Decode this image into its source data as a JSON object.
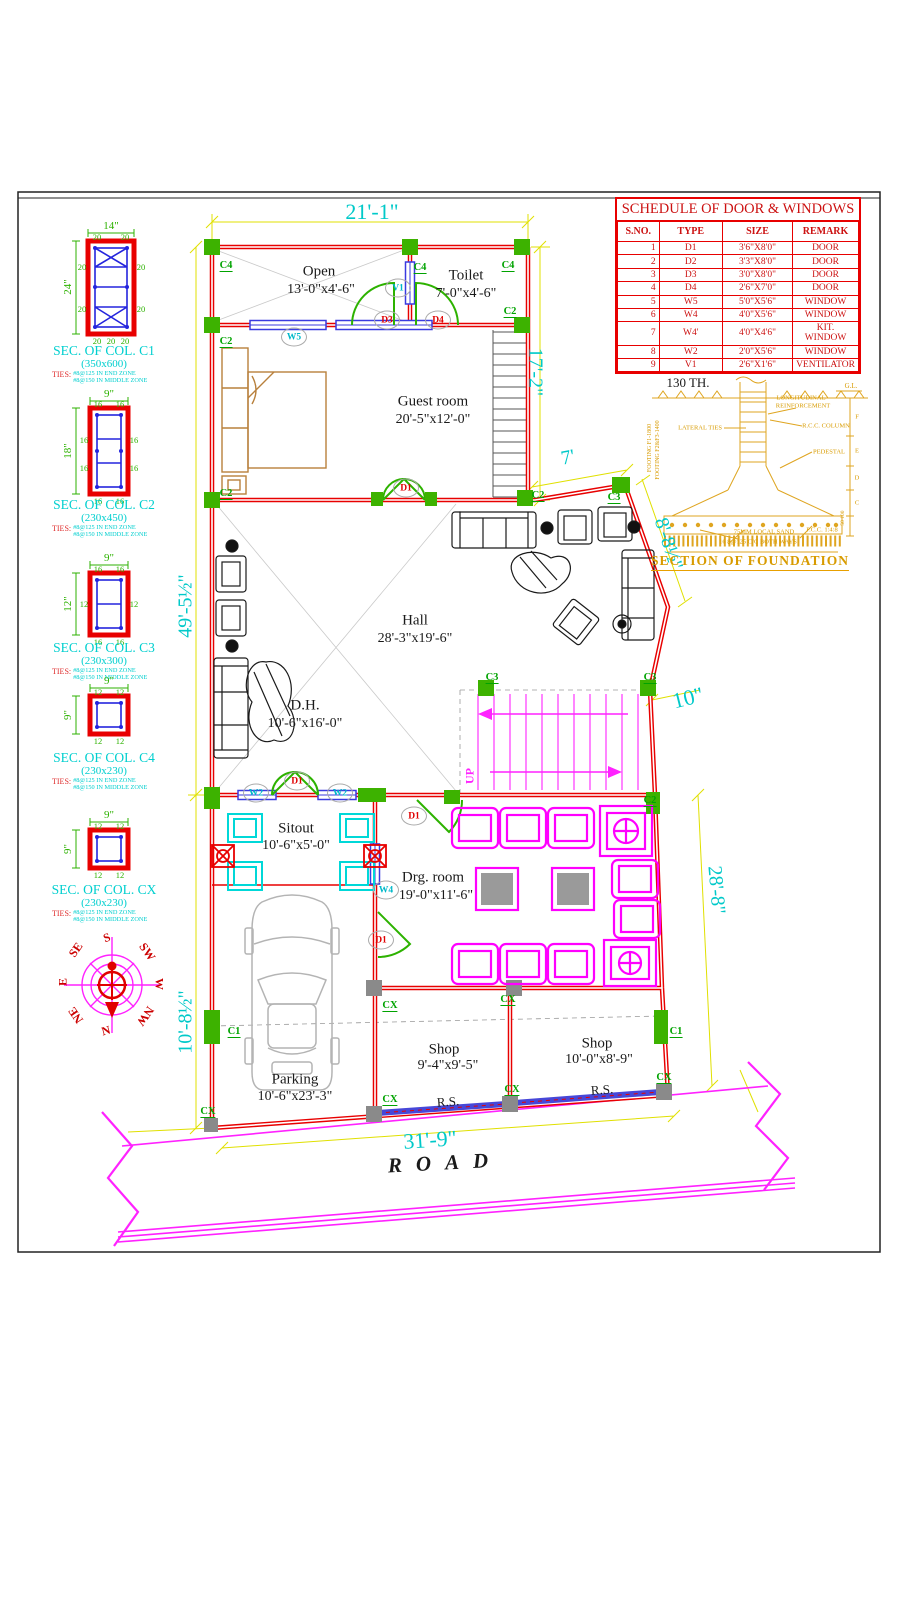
{
  "schedule": {
    "title": "SCHEDULE OF DOOR & WINDOWS",
    "headers": [
      "S.NO.",
      "TYPE",
      "SIZE",
      "REMARK"
    ],
    "rows": [
      [
        "1",
        "D1",
        "3'6\"X8'0\"",
        "DOOR"
      ],
      [
        "2",
        "D2",
        "3'3\"X8'0\"",
        "DOOR"
      ],
      [
        "3",
        "D3",
        "3'0\"X8'0\"",
        "DOOR"
      ],
      [
        "4",
        "D4",
        "2'6\"X7'0\"",
        "DOOR"
      ],
      [
        "5",
        "W5",
        "5'0\"X5'6\"",
        "WINDOW"
      ],
      [
        "6",
        "W4",
        "4'0\"X5'6\"",
        "WINDOW"
      ],
      [
        "7",
        "W4'",
        "4'0\"X4'6\"",
        "KIT. WINDOW"
      ],
      [
        "8",
        "W2",
        "2'0\"X5'6\"",
        "WINDOW"
      ],
      [
        "9",
        "V1",
        "2'6\"X1'6\"",
        "VENTILATOR"
      ]
    ]
  },
  "col_sections": {
    "ties_label": "TIES:",
    "ties_end": "#8@125 IN END ZONE",
    "ties_mid": "#8@150 IN MIDDLE ZONE",
    "items": [
      {
        "title": "SEC. OF COL. C1",
        "size": "(350x600)",
        "width_dim": "14\"",
        "height_dim": "24\"",
        "bar_top": "20",
        "bar_side": "20"
      },
      {
        "title": "SEC. OF COL. C2",
        "size": "(230x450)",
        "width_dim": "9\"",
        "height_dim": "18\"",
        "bar_top": "16",
        "bar_side": "16"
      },
      {
        "title": "SEC. OF COL. C3",
        "size": "(230x300)",
        "width_dim": "9\"",
        "height_dim": "12\"",
        "bar_top": "16",
        "bar_side": "12"
      },
      {
        "title": "SEC. OF COL. C4",
        "size": "(230x230)",
        "width_dim": "9\"",
        "height_dim": "9\"",
        "bar_top": "12",
        "bar_side": "12"
      },
      {
        "title": "SEC. OF COL. CX",
        "size": "(230x230)",
        "width_dim": "9\"",
        "height_dim": "9\"",
        "bar_top": "12",
        "bar_side": "12"
      }
    ]
  },
  "compass": {
    "n": "N",
    "ne": "NE",
    "e": "E",
    "se": "SE",
    "s": "S",
    "sw": "SW",
    "w": "W",
    "nw": "NW"
  },
  "rooms": [
    {
      "name": "Open",
      "dim": "13'-0\"x4'-6\""
    },
    {
      "name": "Toilet",
      "dim": "7'-0\"x4'-6\""
    },
    {
      "name": "Guest room",
      "dim": "20'-5\"x12'-0\""
    },
    {
      "name": "Hall",
      "dim": "28'-3\"x19'-6\""
    },
    {
      "name": "D.H.",
      "dim": "10'-6\"x16'-0\""
    },
    {
      "name": "Sitout",
      "dim": "10'-6\"x5'-0\""
    },
    {
      "name": "Drg. room",
      "dim": "19'-0\"x11'-6\""
    },
    {
      "name": "Parking",
      "dim": "10'-6\"x23'-3\""
    },
    {
      "name": "Shop",
      "dim": "9'-4\"x9'-5\""
    },
    {
      "name": "Shop",
      "dim": "10'-0\"x8'-9\""
    }
  ],
  "dims": {
    "top": "21'-1\"",
    "right_stair": "17'-2\"",
    "slant_top": "7'",
    "slant_right": "8'-8½\"",
    "offset": "10\"",
    "right_lower": "28'-8\"",
    "left_upper": "49'-5½\"",
    "left_lower": "10'-8½\"",
    "bottom": "31'-9\"",
    "wall_th": "130 TH."
  },
  "markers": {
    "d1": "D1",
    "d3": "D3",
    "d4": "D4",
    "v1": "V1",
    "w5": "W5",
    "w2": "W2",
    "w4": "W4",
    "c1": "C1",
    "c2": "C2",
    "c3": "C3",
    "c4": "C4",
    "cx": "CX",
    "up": "UP",
    "rs": "R.S."
  },
  "road_label": "ROAD",
  "foundation": {
    "gl": "G.L.",
    "long_reinf_1": "LONGITUDINAL",
    "long_reinf_2": "REINFORCEMENT",
    "lateral_ties": "LATERAL TIES",
    "rcc_column": "R.C.C. COLUMN",
    "pedestal": "PEDESTAL",
    "footing_1": "FOOTING F1-1800",
    "footing_2": "FOOTING F2&F3-1400",
    "sand": "75MM LOCAL SAND",
    "mesh": "16 8@125 C/C BOTH WAYS",
    "pcc": "P.C.C. 1:4:8",
    "title": "SECTION OF FOUNDATION",
    "levels": [
      "F",
      "E",
      "D",
      "C"
    ],
    "scale_note": "50 100"
  },
  "colors": {
    "wall_red": "#e80000",
    "column_green": "#3db200",
    "dim_cyan": "#00c9c9",
    "dim_yellow": "#e0e000",
    "stair_magenta": "#ff22ff",
    "window_blue": "#3a3ae0",
    "foundation_orange": "#dfa520",
    "furniture_tan": "#b8803c",
    "sitout_cyan": "#00d8d8",
    "drg_magenta": "#ff00ff"
  }
}
